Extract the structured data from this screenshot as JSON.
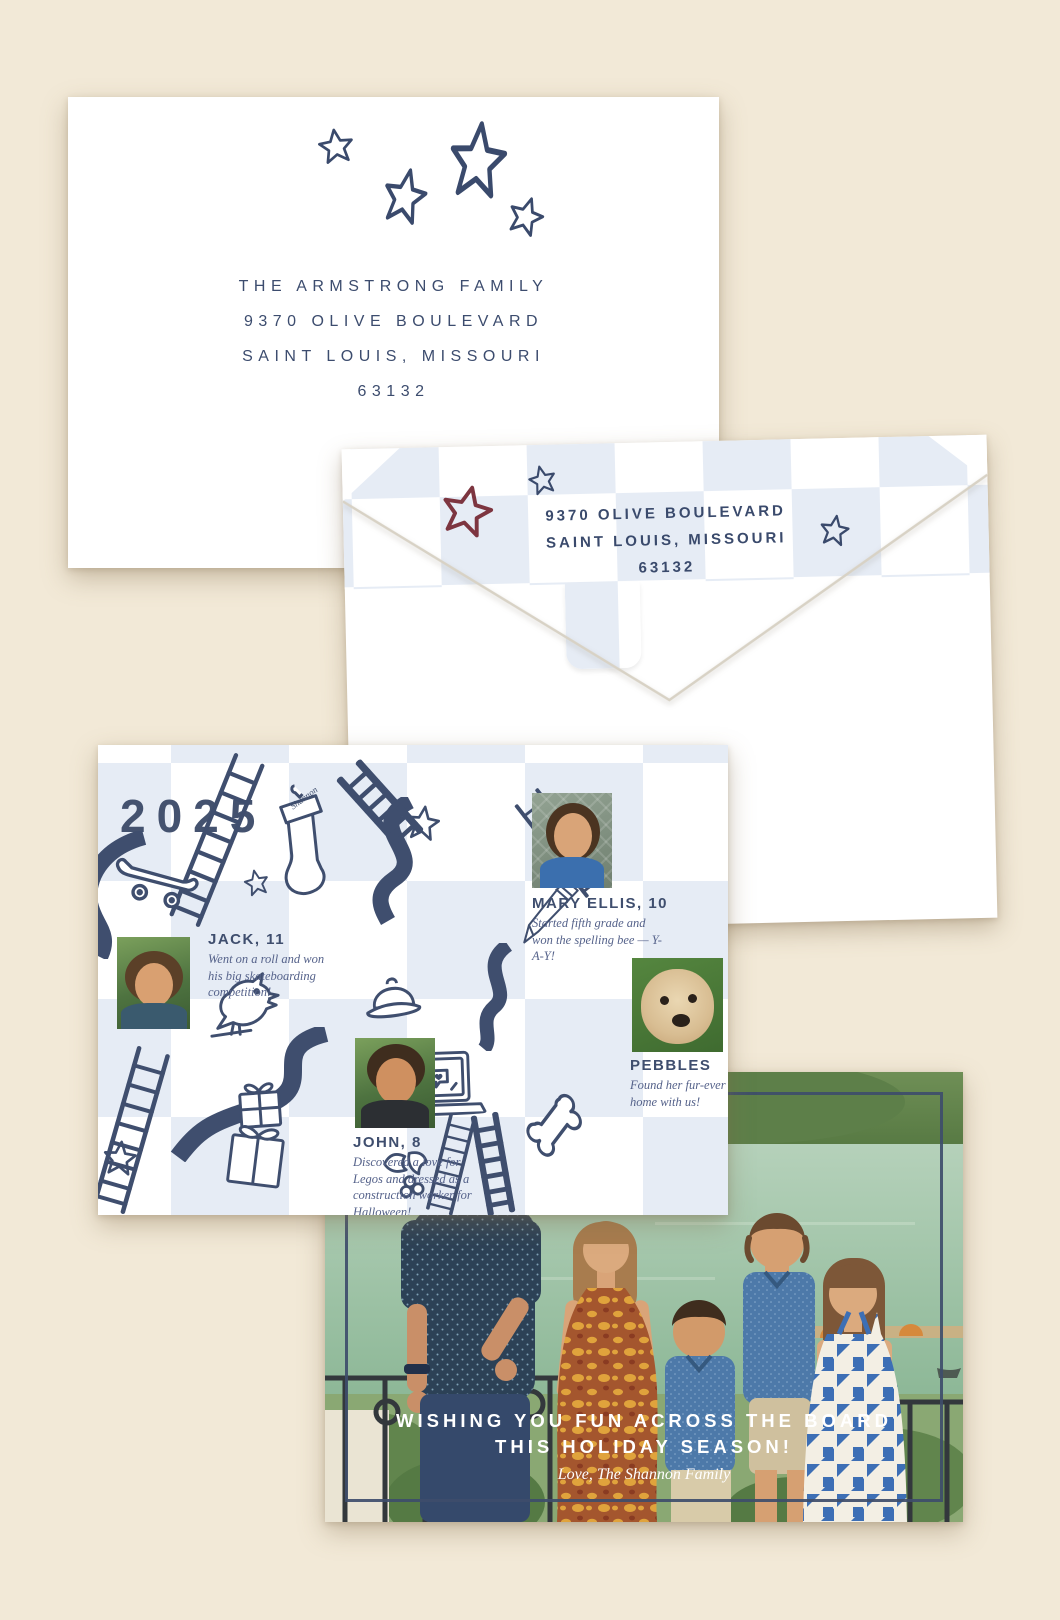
{
  "colors": {
    "background_cream": "#f2e9d7",
    "navy_ink": "#3f4e6e",
    "checker_blue": "#e6ecf5",
    "red_star": "#7d3540",
    "caption_slate": "#55628a",
    "greeting_white": "#ffffff"
  },
  "envelope_front": {
    "recipient_lines": {
      "0": "THE ARMSTRONG FAMILY",
      "1": "9370 OLIVE BOULEVARD",
      "2": "SAINT LOUIS, MISSOURI",
      "3": "63132"
    }
  },
  "envelope_back": {
    "return_lines": {
      "0": "9370 OLIVE BOULEVARD",
      "1": "SAINT LOUIS, MISSOURI",
      "2": "63132"
    }
  },
  "card_back": {
    "year": "2025",
    "stocking_label": "Shannon",
    "people": {
      "0": {
        "name": "JACK, 11",
        "caption": "Went on a roll and won his big skateboarding competition!"
      },
      "1": {
        "name": "MARY ELLIS, 10",
        "caption": "Started fifth grade and won the spelling bee — Y-A-Y!"
      },
      "2": {
        "name": "JOHN, 8",
        "caption": "Discovered a love for Legos and dressed as a construction worker for Halloween!"
      },
      "3": {
        "name": "PEBBLES",
        "caption": "Found her fur-ever home with us!"
      }
    }
  },
  "card_front": {
    "headline_line1": "WISHING YOU FUN ACROSS THE BOARD",
    "headline_line2": "THIS HOLIDAY SEASON!",
    "signoff": "Love, The Shannon Family"
  }
}
